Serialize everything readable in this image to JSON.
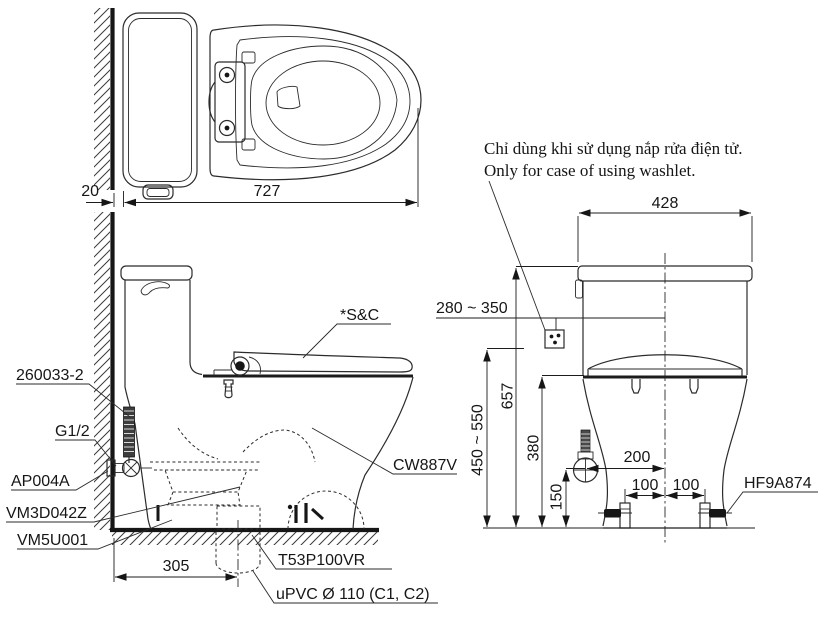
{
  "note": {
    "vi": "Chỉ dùng khi sử dụng nắp rửa điện tử.",
    "en": "Only for case of using washlet."
  },
  "top_view": {
    "dim_wall_gap": "20",
    "dim_total_length": "727"
  },
  "side_view": {
    "dim_drain_offset": "305",
    "labels": {
      "supply_hose": "260033-2",
      "thread_size": "G1/2",
      "stop_valve": "AP004A",
      "gasket": "VM3D042Z",
      "floor_flange": "VM5U001",
      "seat_cover": "*S&C",
      "bowl_model": "CW887V",
      "drain_socket": "T53P100VR",
      "drain_pipe": "uPVC Ø 110 (C1, C2)"
    }
  },
  "front_view": {
    "dims": {
      "tank_width": "428",
      "outlet_height_range": "280 ~ 350",
      "total_height": "657",
      "hose_height_range": "450 ~ 550",
      "rim_height": "380",
      "inlet_height": "150",
      "inlet_offset": "200",
      "bolt_left_offset": "100",
      "bolt_right_offset": "100"
    },
    "labels": {
      "bolt_cap": "HF9A874"
    }
  },
  "icons": {
    "outlet_symbol": "power-outlet-symbol"
  },
  "colors": {
    "line": "#2b2b2b",
    "heavy": "#161616",
    "background": "#ffffff"
  }
}
